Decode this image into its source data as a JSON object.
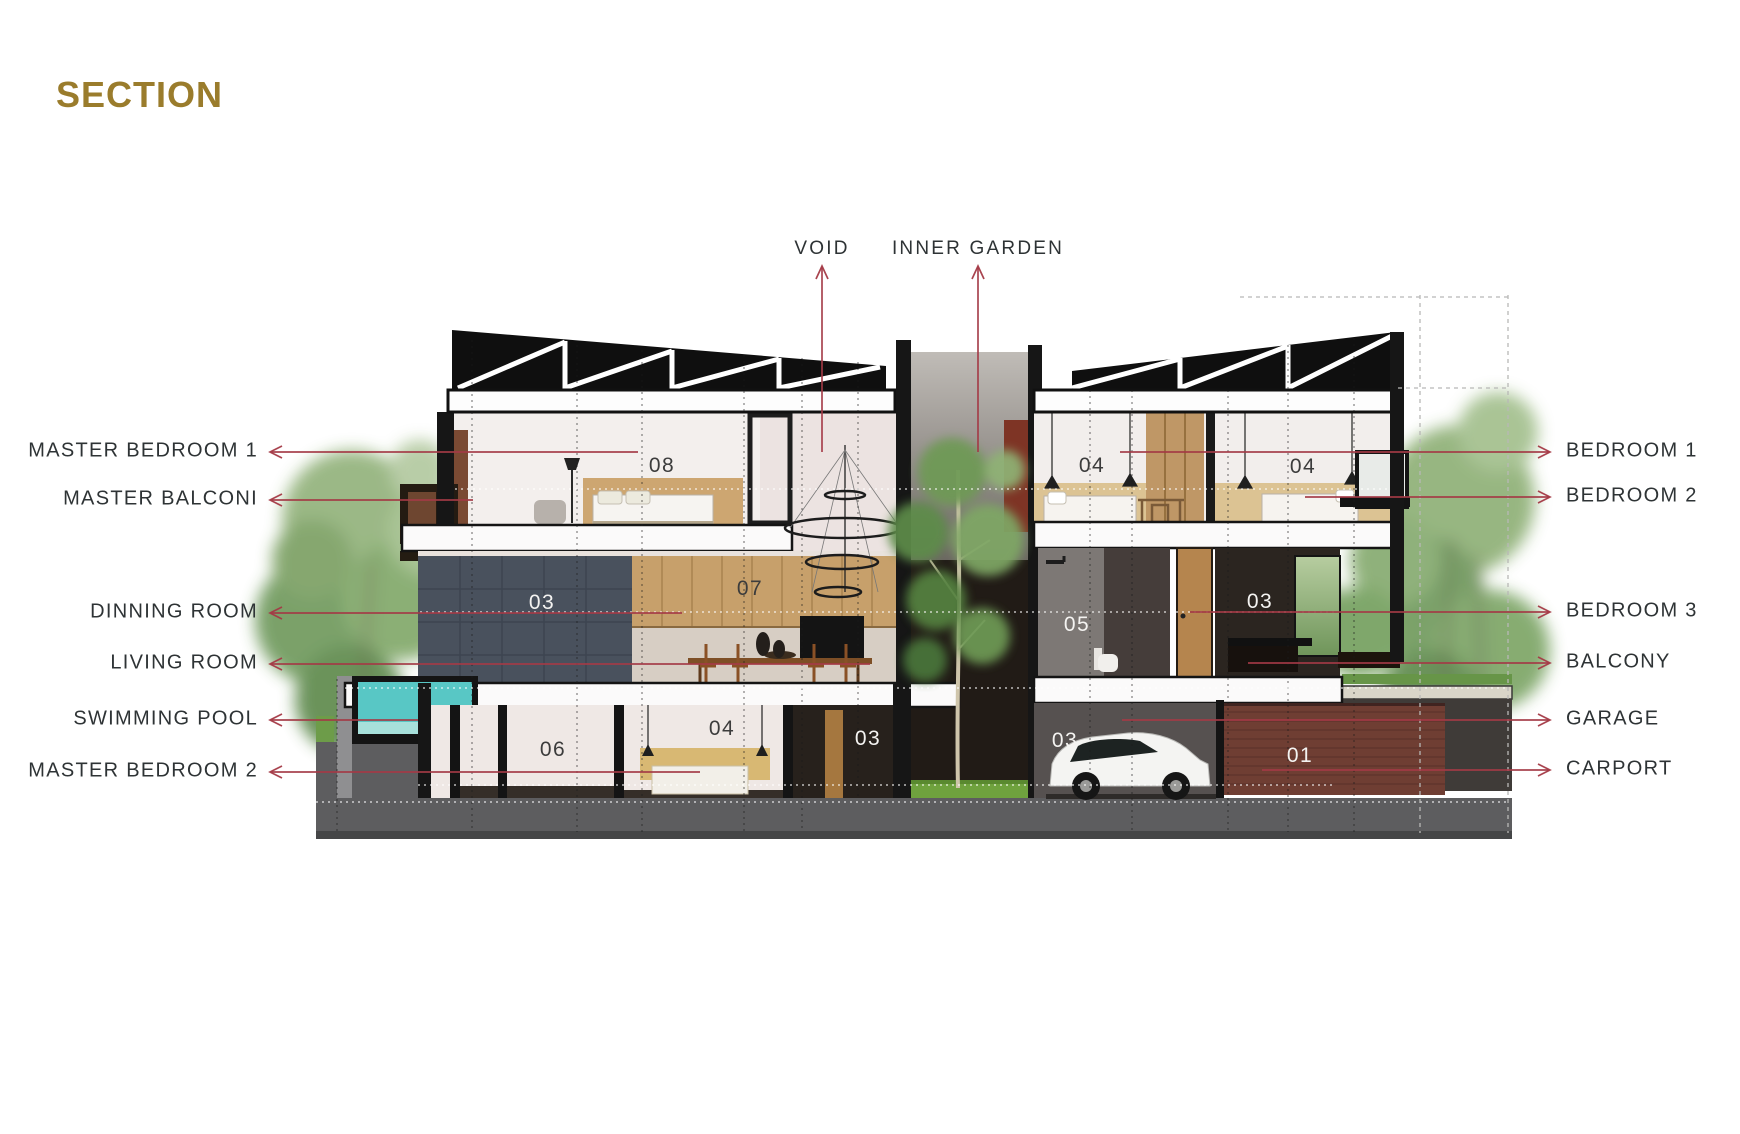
{
  "title": "SECTION",
  "colors": {
    "accent": "#a43a46",
    "title": "#9a7c2c",
    "label": "#2e3335",
    "number_dark": "#3c3c3c",
    "number_light": "#f4f3f1"
  },
  "annotations": {
    "top": [
      {
        "label": "VOID",
        "x": 822,
        "text_y": 249,
        "line_top": 263,
        "line_bottom": 452
      },
      {
        "label": "INNER GARDEN",
        "x": 978,
        "text_y": 249,
        "line_top": 263,
        "line_bottom": 452
      }
    ],
    "left": [
      {
        "label": "MASTER BEDROOM 1",
        "y": 452,
        "x_text": 258,
        "x_arrow": 268,
        "x_end": 638
      },
      {
        "label": "MASTER BALCONI",
        "y": 500,
        "x_text": 258,
        "x_arrow": 268,
        "x_end": 473
      },
      {
        "label": "DINNING ROOM",
        "y": 613,
        "x_text": 258,
        "x_arrow": 268,
        "x_end": 682
      },
      {
        "label": "LIVING ROOM",
        "y": 664,
        "x_text": 258,
        "x_arrow": 268,
        "x_end": 870
      },
      {
        "label": "SWIMMING POOL",
        "y": 720,
        "x_text": 258,
        "x_arrow": 268,
        "x_end": 418
      },
      {
        "label": "MASTER BEDROOM 2",
        "y": 772,
        "x_text": 258,
        "x_arrow": 268,
        "x_end": 700
      }
    ],
    "right": [
      {
        "label": "BEDROOM 1",
        "y": 452,
        "x_text": 1566,
        "x_arrow": 1552,
        "x_start": 1120
      },
      {
        "label": "BEDROOM 2",
        "y": 497,
        "x_text": 1566,
        "x_arrow": 1552,
        "x_start": 1305
      },
      {
        "label": "BEDROOM 3",
        "y": 612,
        "x_text": 1566,
        "x_arrow": 1552,
        "x_start": 1190
      },
      {
        "label": "BALCONY",
        "y": 663,
        "x_text": 1566,
        "x_arrow": 1552,
        "x_start": 1248
      },
      {
        "label": "GARAGE",
        "y": 720,
        "x_text": 1566,
        "x_arrow": 1552,
        "x_start": 1122
      },
      {
        "label": "CARPORT",
        "y": 770,
        "x_text": 1566,
        "x_arrow": 1552,
        "x_start": 1262
      }
    ]
  },
  "room_numbers": [
    {
      "id": "master-bedroom-1",
      "label": "08",
      "x": 662,
      "y": 466,
      "tone": "dark"
    },
    {
      "id": "bedroom-1",
      "label": "04",
      "x": 1092,
      "y": 466,
      "tone": "dark"
    },
    {
      "id": "bedroom-2",
      "label": "04",
      "x": 1303,
      "y": 467,
      "tone": "dark"
    },
    {
      "id": "kitchen-cabinets",
      "label": "07",
      "x": 750,
      "y": 589,
      "tone": "dark"
    },
    {
      "id": "dining-feature-wall",
      "label": "03",
      "x": 542,
      "y": 603,
      "tone": "light"
    },
    {
      "id": "bathroom",
      "label": "05",
      "x": 1077,
      "y": 625,
      "tone": "light"
    },
    {
      "id": "bedroom-3",
      "label": "03",
      "x": 1260,
      "y": 602,
      "tone": "light"
    },
    {
      "id": "basement-room",
      "label": "06",
      "x": 553,
      "y": 750,
      "tone": "dark"
    },
    {
      "id": "master-bedroom-2",
      "label": "04",
      "x": 722,
      "y": 729,
      "tone": "dark"
    },
    {
      "id": "lower-hall",
      "label": "03",
      "x": 868,
      "y": 739,
      "tone": "light"
    },
    {
      "id": "garage",
      "label": "03",
      "x": 1065,
      "y": 741,
      "tone": "light"
    },
    {
      "id": "carport-wall",
      "label": "01",
      "x": 1300,
      "y": 756,
      "tone": "light"
    }
  ]
}
